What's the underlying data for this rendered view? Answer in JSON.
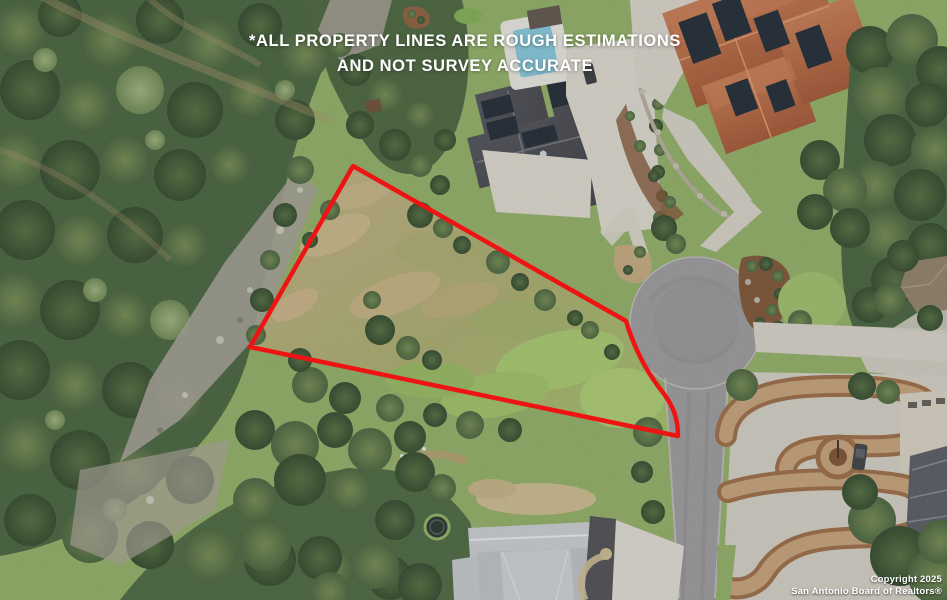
{
  "overlay": {
    "disclaimer": {
      "line1": "*ALL PROPERTY LINES ARE ROUGH ESTIMATIONS",
      "line2": "AND NOT SURVEY ACCURATE"
    },
    "copyright": {
      "line1": "Copyright 2025",
      "line2": "San Antonio Board of Realtors®"
    }
  },
  "colors": {
    "boundary_red": "#ee1414",
    "overlay_text": "#ffffff"
  },
  "boundary": {
    "path": "M 353,166 L 626,321 C 635,351 647,372 661,390 C 673,405 678,418 678,436 L 250,347 Z",
    "stroke_width": "4.5"
  }
}
